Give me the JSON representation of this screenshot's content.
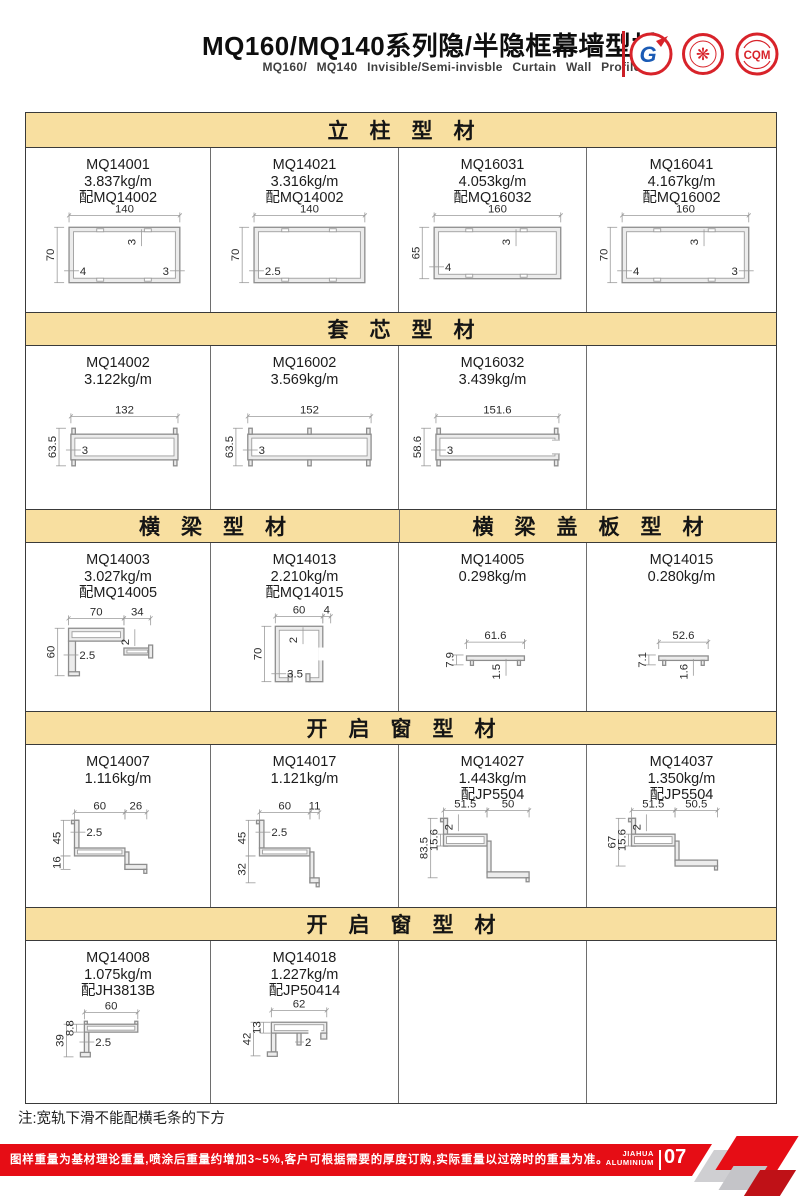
{
  "header": {
    "title": "MQ160/MQ140系列隐/半隐框幕墙型材",
    "subtitle": "MQ160/ MQ140 Invisible/Semi-invisble Curtain Wall Profiles",
    "logos": [
      {
        "name": "gb-cert-logo",
        "text": "G"
      },
      {
        "name": "seal-cert-logo",
        "text": "❋"
      },
      {
        "name": "cqm-cert-logo",
        "text": "CQM"
      }
    ]
  },
  "colors": {
    "red": "#e60d15",
    "dark_red": "#bf1117",
    "gray_shape": "#cfcfd2",
    "tan_header": "#f8dfa0",
    "table_border": "#3a3a3a",
    "logo_red": "#d8232a",
    "logo_blue": "#1b5bb5"
  },
  "table": {
    "sections": [
      {
        "headers": [
          {
            "text": "立　柱　型　材",
            "span": 4
          }
        ],
        "cells": [
          {
            "model": "MQ14001",
            "weight": "3.837kg/m",
            "match": "配MQ14002",
            "shape": "box",
            "dims": {
              "w": "140",
              "h": "70",
              "top": "3",
              "left": "4",
              "right": "3"
            }
          },
          {
            "model": "MQ14021",
            "weight": "3.316kg/m",
            "match": "配MQ14002",
            "shape": "box",
            "dims": {
              "w": "140",
              "h": "70",
              "left": "2.5"
            }
          },
          {
            "model": "MQ16031",
            "weight": "4.053kg/m",
            "match": "配MQ16032",
            "shape": "box",
            "dims": {
              "w": "160",
              "h": "65",
              "top": "3",
              "left": "4"
            }
          },
          {
            "model": "MQ16041",
            "weight": "4.167kg/m",
            "match": "配MQ16002",
            "shape": "box",
            "dims": {
              "w": "160",
              "h": "70",
              "top": "3",
              "left": "4",
              "right": "3"
            }
          }
        ]
      },
      {
        "headers": [
          {
            "text": "套　芯　型　材",
            "span": 4
          }
        ],
        "cells": [
          {
            "model": "MQ14002",
            "weight": "3.122kg/m",
            "shape": "core",
            "dims": {
              "w": "132",
              "h": "63.5",
              "t": "3"
            }
          },
          {
            "model": "MQ16002",
            "weight": "3.569kg/m",
            "shape": "core",
            "variant": "midtabs",
            "dims": {
              "w": "152",
              "h": "63.5",
              "t": "3"
            }
          },
          {
            "model": "MQ16032",
            "weight": "3.439kg/m",
            "shape": "core",
            "variant": "notch",
            "dims": {
              "w": "151.6",
              "h": "58.6",
              "t": "3"
            }
          },
          {
            "empty": true
          }
        ]
      },
      {
        "headers": [
          {
            "text": "横　梁　型　材",
            "span": 2
          },
          {
            "text": "横　梁　盖　板　型　材",
            "span": 2
          }
        ],
        "cells": [
          {
            "model": "MQ14003",
            "weight": "3.027kg/m",
            "match": "配MQ14005",
            "shape": "beamH",
            "dims": {
              "w1": "70",
              "w2": "34",
              "h": "60",
              "t2": "2",
              "t": "2.5"
            }
          },
          {
            "model": "MQ14013",
            "weight": "2.210kg/m",
            "match": "配MQ14015",
            "shape": "beamU",
            "dims": {
              "w": "60",
              "ext": "4",
              "h": "70",
              "t2": "2",
              "t": "3.5"
            }
          },
          {
            "model": "MQ14005",
            "weight": "0.298kg/m",
            "shape": "cap",
            "dims": {
              "w": "61.6",
              "h": "7.9",
              "t": "1.5"
            }
          },
          {
            "model": "MQ14015",
            "weight": "0.280kg/m",
            "shape": "cap",
            "dims": {
              "w": "52.6",
              "h": "7.1",
              "t": "1.6"
            }
          }
        ]
      },
      {
        "headers": [
          {
            "text": "开　启　窗　型　材",
            "span": 4
          }
        ],
        "cells": [
          {
            "model": "MQ14007",
            "weight": "1.116kg/m",
            "shape": "step1",
            "dims": {
              "w1": "60",
              "w2": "26",
              "h1": "45",
              "h2": "16",
              "t": "2.5"
            }
          },
          {
            "model": "MQ14017",
            "weight": "1.121kg/m",
            "shape": "step1",
            "dims": {
              "w1": "60",
              "w2": "11",
              "h1": "45",
              "h2": "32",
              "t": "2.5"
            }
          },
          {
            "model": "MQ14027",
            "weight": "1.443kg/m",
            "match": "配JP5504",
            "shape": "step2",
            "dims": {
              "w1": "51.5",
              "w2": "50",
              "h": "83.5",
              "h2": "15.6",
              "t": "2"
            }
          },
          {
            "model": "MQ14037",
            "weight": "1.350kg/m",
            "match": "配JP5504",
            "shape": "step2",
            "dims": {
              "w1": "51.5",
              "w2": "50.5",
              "h": "67",
              "h2": "15.6",
              "t": "2"
            }
          }
        ]
      },
      {
        "headers": [
          {
            "text": "开　启　窗　型　材",
            "span": 4
          }
        ],
        "cells": [
          {
            "model": "MQ14008",
            "weight": "1.075kg/m",
            "match": "配JH3813B",
            "shape": "win1",
            "dims": {
              "w": "60",
              "h": "39",
              "h2": "8.8",
              "t": "2.5"
            }
          },
          {
            "model": "MQ14018",
            "weight": "1.227kg/m",
            "match": "配JP50414",
            "shape": "win2",
            "dims": {
              "w": "62",
              "h": "42",
              "h2": "13",
              "t": "2"
            }
          },
          {
            "empty": true
          },
          {
            "empty": true
          }
        ]
      }
    ]
  },
  "note": "注:宽轨下滑不能配横毛条的下方",
  "footer": {
    "text": "图样重量为基材理论重量,喷涂后重量约增加3~5%,客户可根据需要的厚度订购,实际重量以过磅时的重量为准。",
    "brand_line1": "JIAHUA",
    "brand_line2": "ALUMINIUM",
    "page_number": "07"
  }
}
